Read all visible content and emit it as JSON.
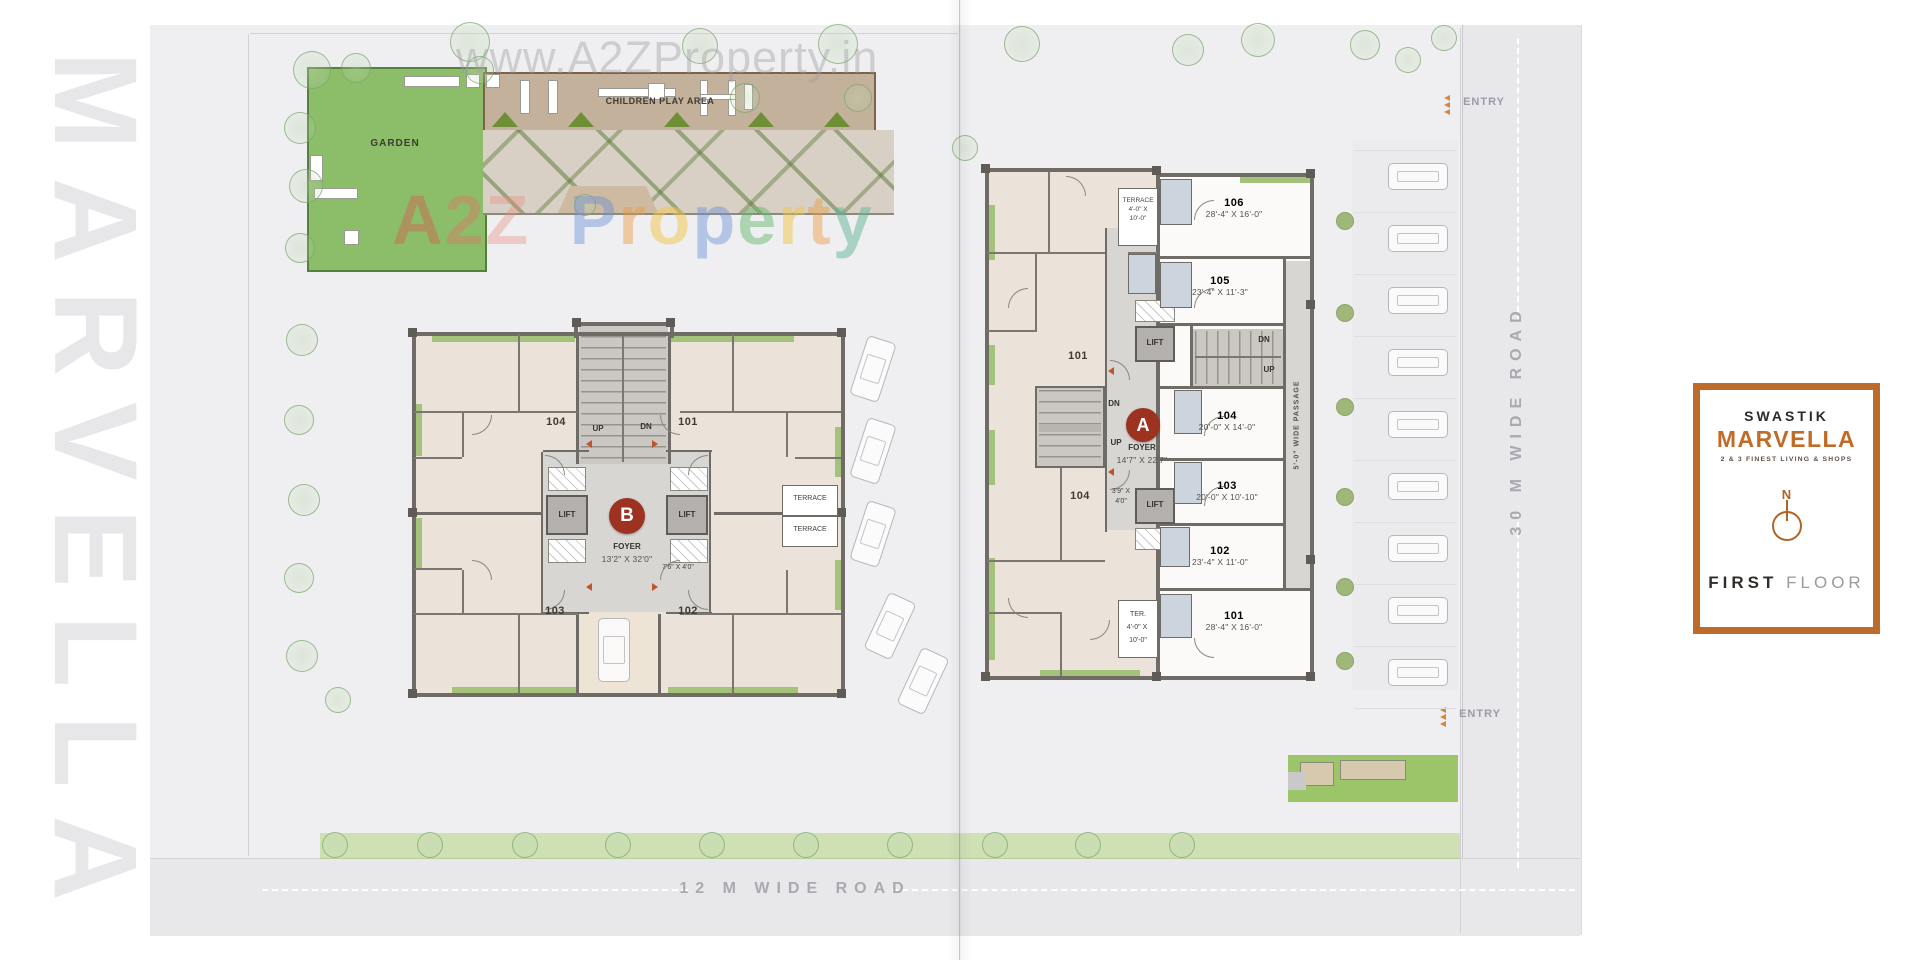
{
  "watermarks": {
    "url_text": "www.A2ZProperty.in",
    "side_text": "MARVELLA",
    "brand_letters": [
      {
        "ch": "A",
        "style": "color:rgba(221,85,78,0.40)"
      },
      {
        "ch": "2",
        "style": "color:rgba(228,110,100,0.38)"
      },
      {
        "ch": "Z",
        "style": "color:rgba(233,140,128,0.38)"
      },
      {
        "ch": " ",
        "style": "padding:0 9px"
      },
      {
        "ch": "P",
        "style": "color:rgba(108,144,214,0.45)"
      },
      {
        "ch": "r",
        "style": "color:rgba(236,152,62,0.45)"
      },
      {
        "ch": "o",
        "style": "color:rgba(242,198,70,0.50)"
      },
      {
        "ch": "p",
        "style": "color:rgba(108,144,214,0.45)"
      },
      {
        "ch": "e",
        "style": "color:rgba(106,186,112,0.50)"
      },
      {
        "ch": "r",
        "style": "color:rgba(242,198,70,0.50)"
      },
      {
        "ch": "t",
        "style": "color:rgba(236,152,62,0.45)"
      },
      {
        "ch": "y",
        "style": "color:rgba(96,182,150,0.50)"
      }
    ]
  },
  "site": {
    "garden": "GARDEN",
    "play_area": "CHILDREN PLAY AREA",
    "road_right": "30 M WIDE ROAD",
    "road_bottom": "12 M WIDE ROAD",
    "entry": "ENTRY"
  },
  "labels": {
    "up": "UP",
    "dn": "DN",
    "lift": "LIFT",
    "terrace": "TERRACE",
    "foyer": "FOYER"
  },
  "building_b": {
    "badge": "B",
    "foyer_dim": "13'2\" X 32'0\"",
    "lobby_dim": "7'6\" X 4'0\"",
    "units": {
      "tl": "104",
      "tr": "101",
      "bl": "103",
      "br": "102"
    }
  },
  "building_a": {
    "badge": "A",
    "foyer_dim": "14'7\" X 22'7\"",
    "lobby_dim_l1": "3'9\" X",
    "lobby_dim_l2": "4'0\"",
    "wing_unit_top": "101",
    "wing_unit_bottom": "104",
    "passage": "5'-0\" WIDE PASSAGE",
    "terrace_top": {
      "l1": "TERRACE",
      "l2": "4'-0\" X",
      "l3": "10'-0\""
    },
    "terrace_bottom": {
      "l1": "TER.",
      "l2": "4'-0\" X",
      "l3": "10'-0\""
    },
    "shops": [
      {
        "no": "106",
        "dim": "28'-4\" X 16'-0\""
      },
      {
        "no": "105",
        "dim": "23'-4\" X 11'-3\""
      },
      {
        "no": "104",
        "dim": "20'-0\" X 14'-0\""
      },
      {
        "no": "103",
        "dim": "20'-0\" X 10'-10\""
      },
      {
        "no": "102",
        "dim": "23'-4\" X 11'-0\""
      },
      {
        "no": "101",
        "dim": "28'-4\" X 16'-0\""
      }
    ]
  },
  "legend": {
    "brand_top": "SWASTIK",
    "brand_main": "MARVELLA",
    "tagline": "2 & 3 FINEST LIVING & SHOPS",
    "north": "N",
    "floor_bold": "FIRST",
    "floor_light": "FLOOR"
  },
  "colors": {
    "accent_orange": "#bc6b2a",
    "badge_red": "#9e3220",
    "wall": "#6f6b67",
    "garden_green": "#8cbd68"
  }
}
